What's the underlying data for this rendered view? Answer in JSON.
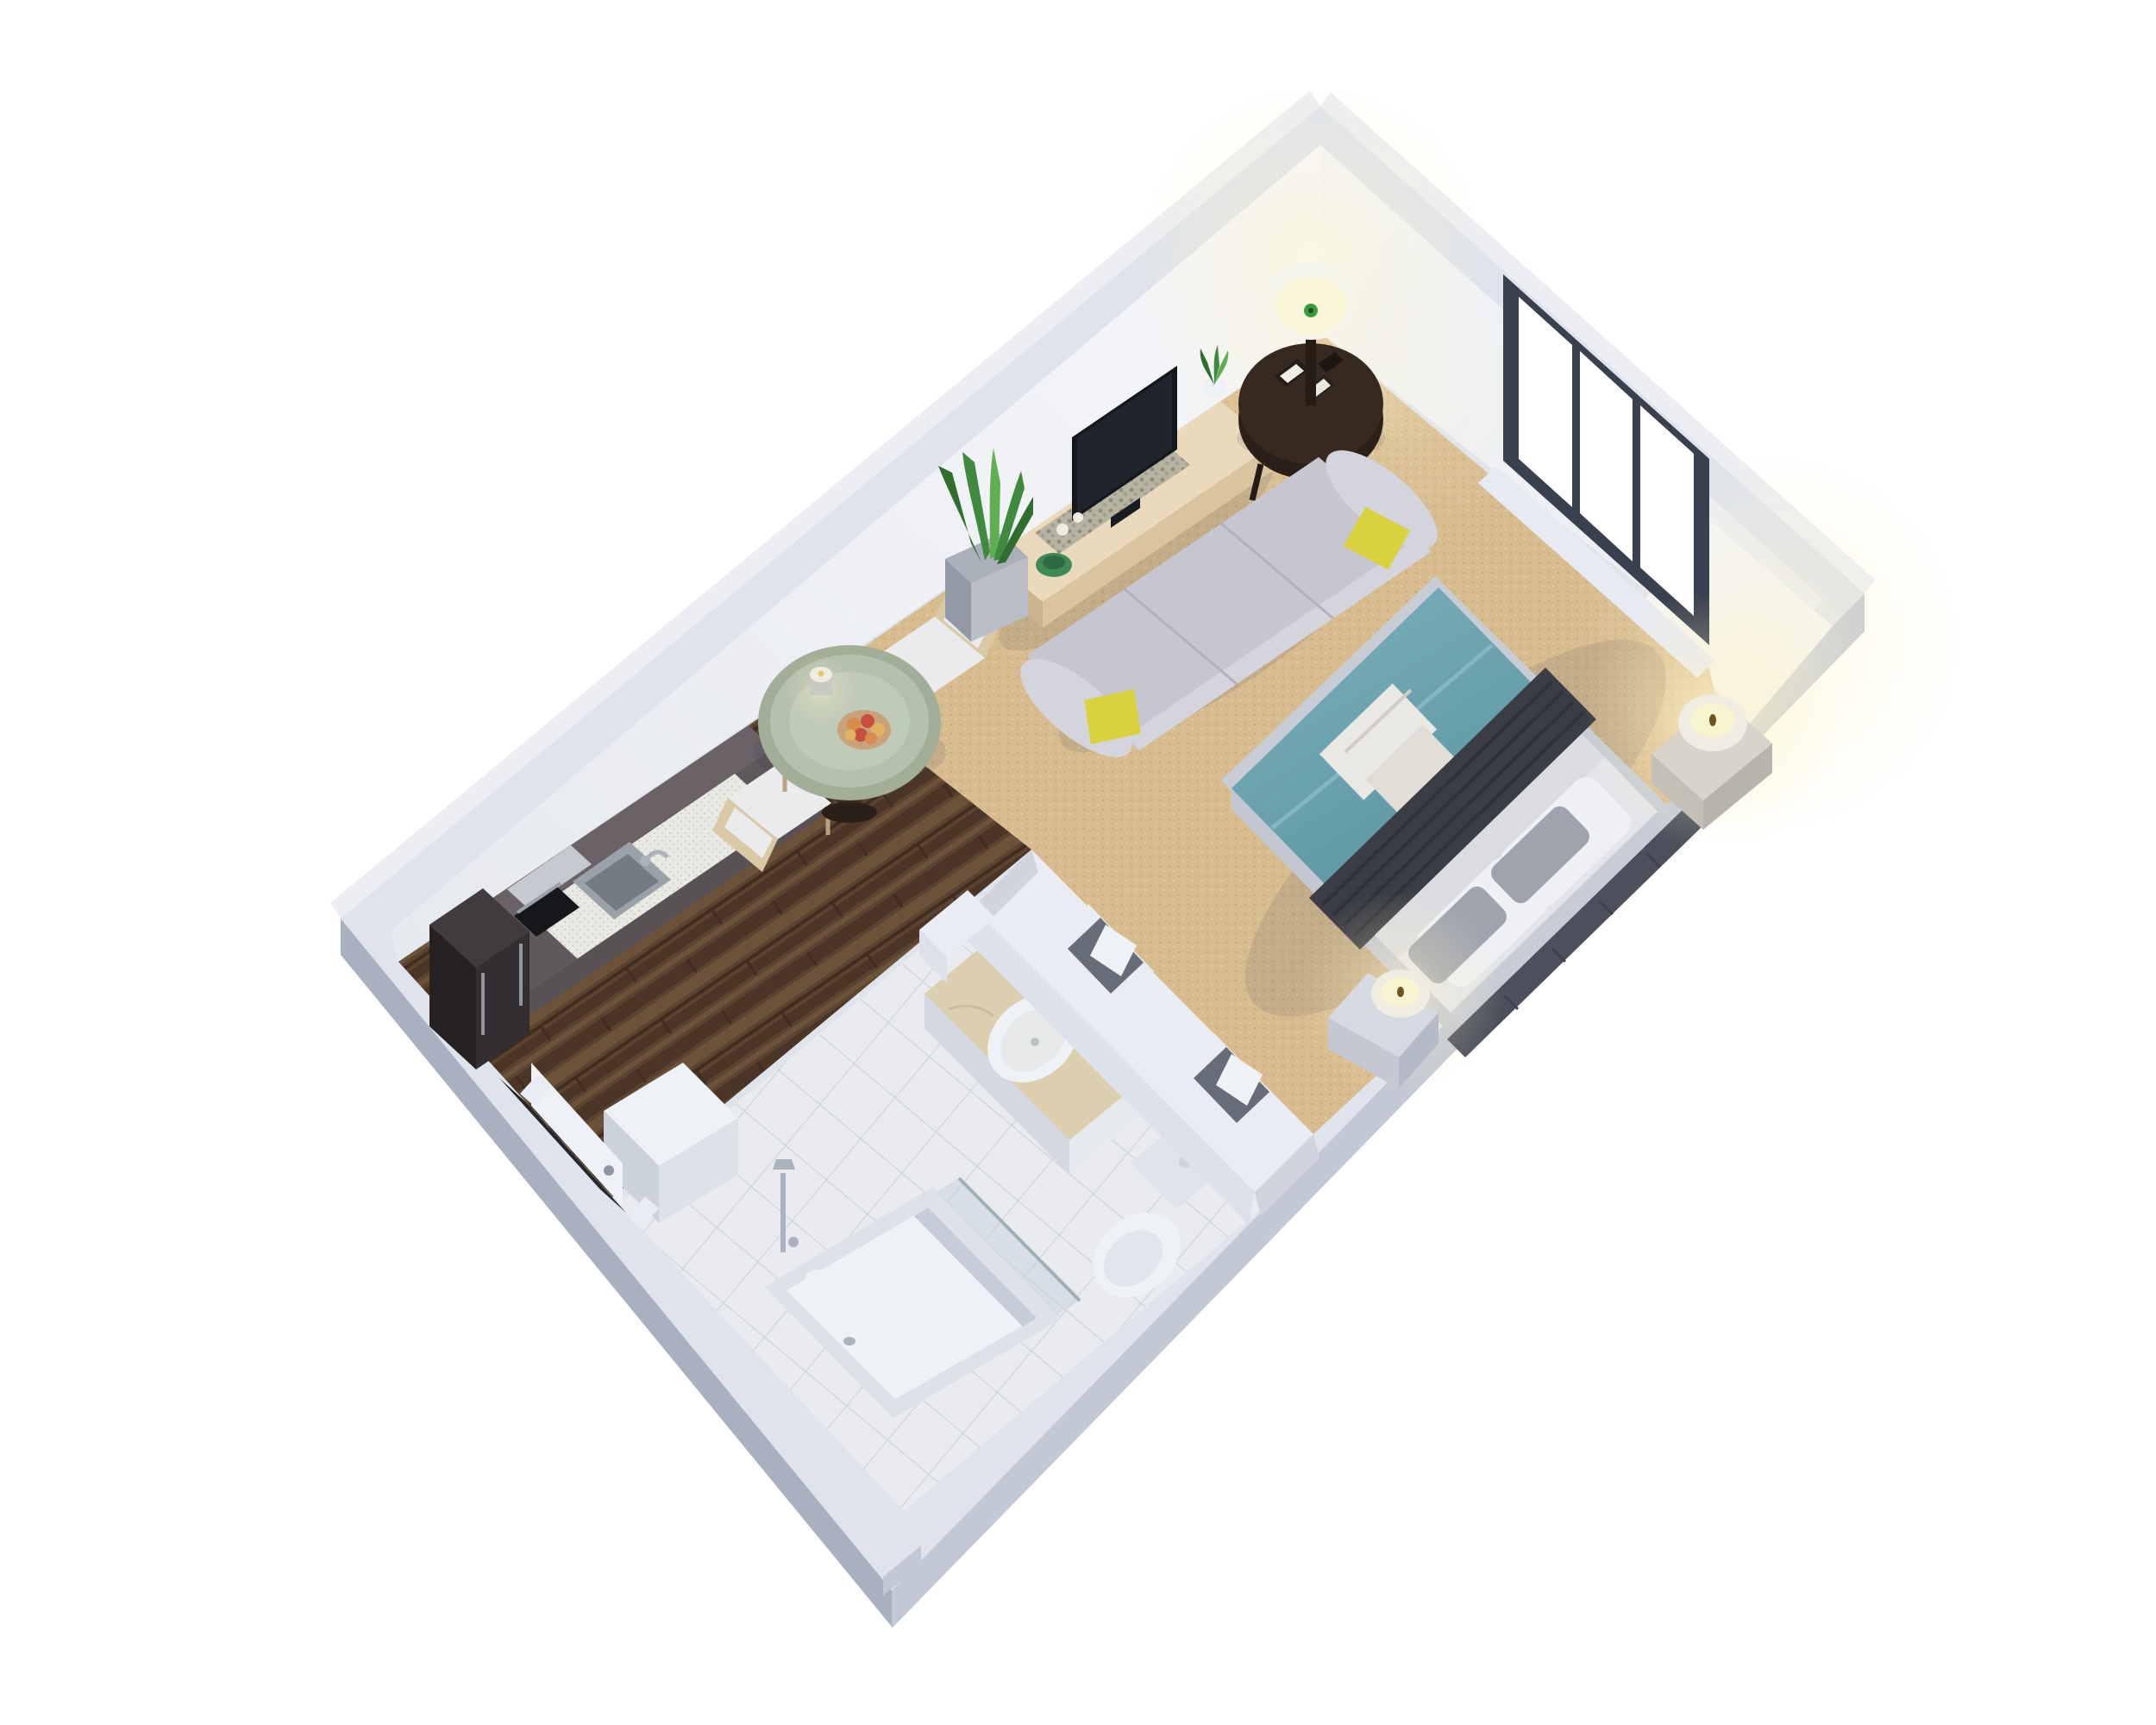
{
  "meta": {
    "title": "3D isometric floor plan of a studio apartment",
    "view": "axonometric top-down, rotated ~40 degrees",
    "background": "white"
  },
  "palette": {
    "background": "#ffffff",
    "wall_top": "#dfe3eb",
    "wall_outer_dark": "#a9b0bf",
    "wall_outer_mid": "#c2c8d4",
    "wall_outer_light": "#eceef3",
    "wall_interior": "#f3f4f7",
    "partition": "#e9ecf2",
    "partition_face": "#dde1e9",
    "partition_cap": "#cfd4de",
    "window_frame": "#39414e",
    "glass": "#ffffff",
    "sill": "#e7eaf0",
    "carpet": "#d7bc90",
    "carpet_dot": "#c9aa7b",
    "carpet_dot2": "#e2cda4",
    "wood": "#5b4331",
    "wood2": "#4a3526",
    "wood3": "#6b5238",
    "wood4": "#3f2d20",
    "tile": "#e9ebee",
    "tile_line": "#cfd4da",
    "teal": "#79afb9",
    "teal_dark": "#5d96a3",
    "throw": "#3a3d44",
    "throw_line": "#2f3238",
    "sheet": "#dadce1",
    "pillow": "#eef0f4",
    "pillow_gray": "#9fa3ae",
    "headboard": "#4c505c",
    "bedbase": "#c7ccd5",
    "bedside": "#c2c7d1",
    "sofa": "#c6c6d0",
    "sofa_light": "#d4d4dd",
    "yellow": "#d8d23f",
    "console": "#ead9bb",
    "console_face": "#d9c49f",
    "console_end": "#c9b48f",
    "tray": "#b6b3a2",
    "tv": "#20242b",
    "cab": "#6a6266",
    "cab_face": "#585257",
    "cab_dark": "#5f585c",
    "counter": "#e9e9e3",
    "steel": "#9aa1a9",
    "steel_dark": "#747b84",
    "fridge": "#413b3e",
    "fridge_face": "#332e31",
    "fridge_side": "#262224",
    "oven": "#15171b",
    "table_top": "#b5c0ae",
    "table_rim": "#a3ae98",
    "table_base": "#3a2e24",
    "chair_wood": "#d9c9a4",
    "chair_seat": "#ebebee",
    "marble": "#dbcfb0",
    "fixture": "#eef1f5",
    "fixture_dim": "#dfe3ea",
    "chrome": "#aab3bd",
    "espresso": "#362a20",
    "espresso_dark": "#2a2018",
    "shade": "#f6f5ec",
    "glow_core": "#fbf8d9",
    "candle": "#efece2",
    "candle_core": "#f7f4cf",
    "plant": "#3f8a3f",
    "plant_dark": "#2f6e2f",
    "plant_light": "#5fae52",
    "planter": "#b9bec7",
    "planter_face": "#939aa5",
    "green_bowl": "#3f8a55",
    "fruit_orange": "#d98b4f",
    "fruit_red": "#c64f3d",
    "fruit_gold": "#e0b264",
    "shadow": "rgba(60,60,85,0.12)",
    "door_recess": "#23262b",
    "glass_pane": "rgba(198,210,220,0.5)"
  },
  "scene": {
    "rooms": [
      {
        "name": "living-sleeping area",
        "floor": "carpet",
        "furniture": [
          "sofa with two yellow pillows",
          "double bed with teal duvet, charcoal throw, folded towels, pillows",
          "tv console with tv, plant, green bowl, candlesticks",
          "round side table with picture frames and floor lamp",
          "snake-plant in square planter",
          "nightstand with lit candle (corner)",
          "nightstand with lit candle (by headboard)",
          "shelf niches beside bathroom wall"
        ]
      },
      {
        "name": "kitchen",
        "floor": "hardwood",
        "furniture": [
          "dark upper cabinets",
          "counter with stainless sink and faucet",
          "built-in oven",
          "tall fridge cabinet"
        ]
      },
      {
        "name": "dining nook",
        "floor": "hardwood",
        "furniture": [
          "round glass table",
          "candle",
          "fruit bowl",
          "two white chairs"
        ]
      },
      {
        "name": "bathroom",
        "floor": "tile",
        "furniture": [
          "vanity with marble top and oval sink",
          "toilet",
          "bathtub with glass screen",
          "shower fixture",
          "toilet-paper roll"
        ]
      },
      {
        "name": "entry hall",
        "floor": "hardwood",
        "furniture": [
          "entry door",
          "white storage cabinet"
        ]
      }
    ],
    "window": {
      "wall": "upper-right",
      "panes": 3,
      "frame": "dark slate"
    },
    "lights": [
      "floor lamp (top corner)",
      "candle (right corner nightstand)",
      "candle (headboard nightstand)",
      "dining candle"
    ]
  }
}
